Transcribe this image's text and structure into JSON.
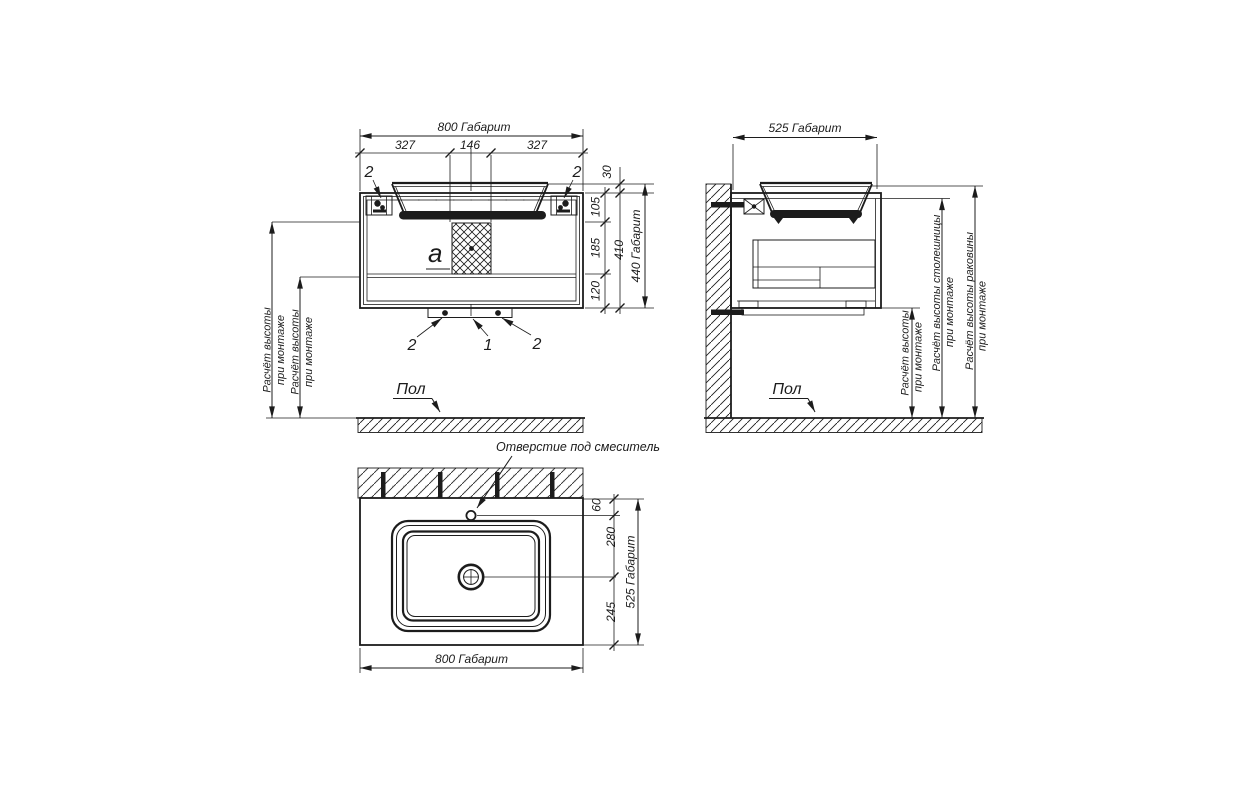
{
  "labels": {
    "floor": "Пол",
    "detail_a": "a",
    "callout_1": "1",
    "callout_2": "2",
    "faucet_hole": "Отверстие под смеситель",
    "mount_height_l1": "Расчёт высоты",
    "mount_height_l2": "при монтаже",
    "countertop_height_l1": "Расчёт высоты столешницы",
    "countertop_height_l2": "при монтаже",
    "sink_height_l1": "Расчёт высоты раковины",
    "sink_height_l2": "при монтаже"
  },
  "front_view": {
    "dim_overall_width": "800 Габарит",
    "dim_seg_left": "327",
    "dim_seg_center": "146",
    "dim_seg_right": "327",
    "dim_rim": "30",
    "dim_top_section": "105",
    "dim_mid_section": "185",
    "dim_bottom_section": "120",
    "dim_body_height": "410",
    "dim_overall_height": "440 Габарит"
  },
  "side_view": {
    "dim_overall_depth": "525 Габарит"
  },
  "plan_view": {
    "dim_faucet_offset": "60",
    "dim_drain_offset": "280",
    "dim_front_edge": "245",
    "dim_overall_depth": "525 Габарит",
    "dim_overall_width": "800 Габарит"
  }
}
